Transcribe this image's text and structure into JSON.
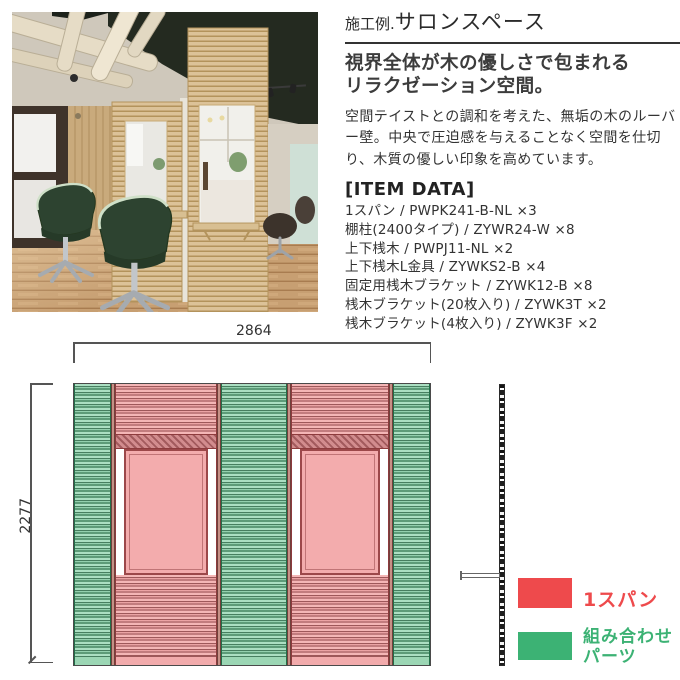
{
  "page": {
    "title_prefix": "施工例.",
    "title_main": "サロンスペース",
    "subtitle": "視界全体が木の優しさで包まれる\nリラクゼーション空間。",
    "body": "空間テイストとの調和を考えた、無垢の木のルーバー壁。中央で圧迫感を与えることなく空間を仕切り、木質の優しい印象を高めています。"
  },
  "item_data": {
    "heading": "[ITEM DATA]",
    "items": [
      {
        "name": "1スパン",
        "code": "PWPK241-B-NL",
        "qty": "×3"
      },
      {
        "name": "棚柱(2400タイプ)",
        "code": "ZYWR24-W",
        "qty": "×8"
      },
      {
        "name": "上下桟木",
        "code": "PWPJ11-NL",
        "qty": "×2"
      },
      {
        "name": "上下桟木L金具",
        "code": "ZYWKS2-B",
        "qty": "×4"
      },
      {
        "name": "固定用桟木ブラケット",
        "code": "ZYWK12-B",
        "qty": "×8"
      },
      {
        "name": "桟木ブラケット(20枚入り)",
        "code": "ZYWK3T",
        "qty": "×2"
      },
      {
        "name": "桟木ブラケット(4枚入り)",
        "code": "ZYWK3F",
        "qty": "×2"
      }
    ]
  },
  "photo": {
    "caption": "木製ルーバー壁とグリーンのセットチェアがあるサロン内観"
  },
  "diagram": {
    "width_mm": "2864",
    "height_mm": "2277",
    "sections": [
      "combo",
      "span",
      "combo",
      "span",
      "combo"
    ],
    "legend": [
      {
        "key": "span",
        "color": "#ee4a4c",
        "label": "1スパン"
      },
      {
        "key": "combo",
        "color": "#3cb274",
        "label": "組み合わせ\nパーツ"
      }
    ]
  }
}
